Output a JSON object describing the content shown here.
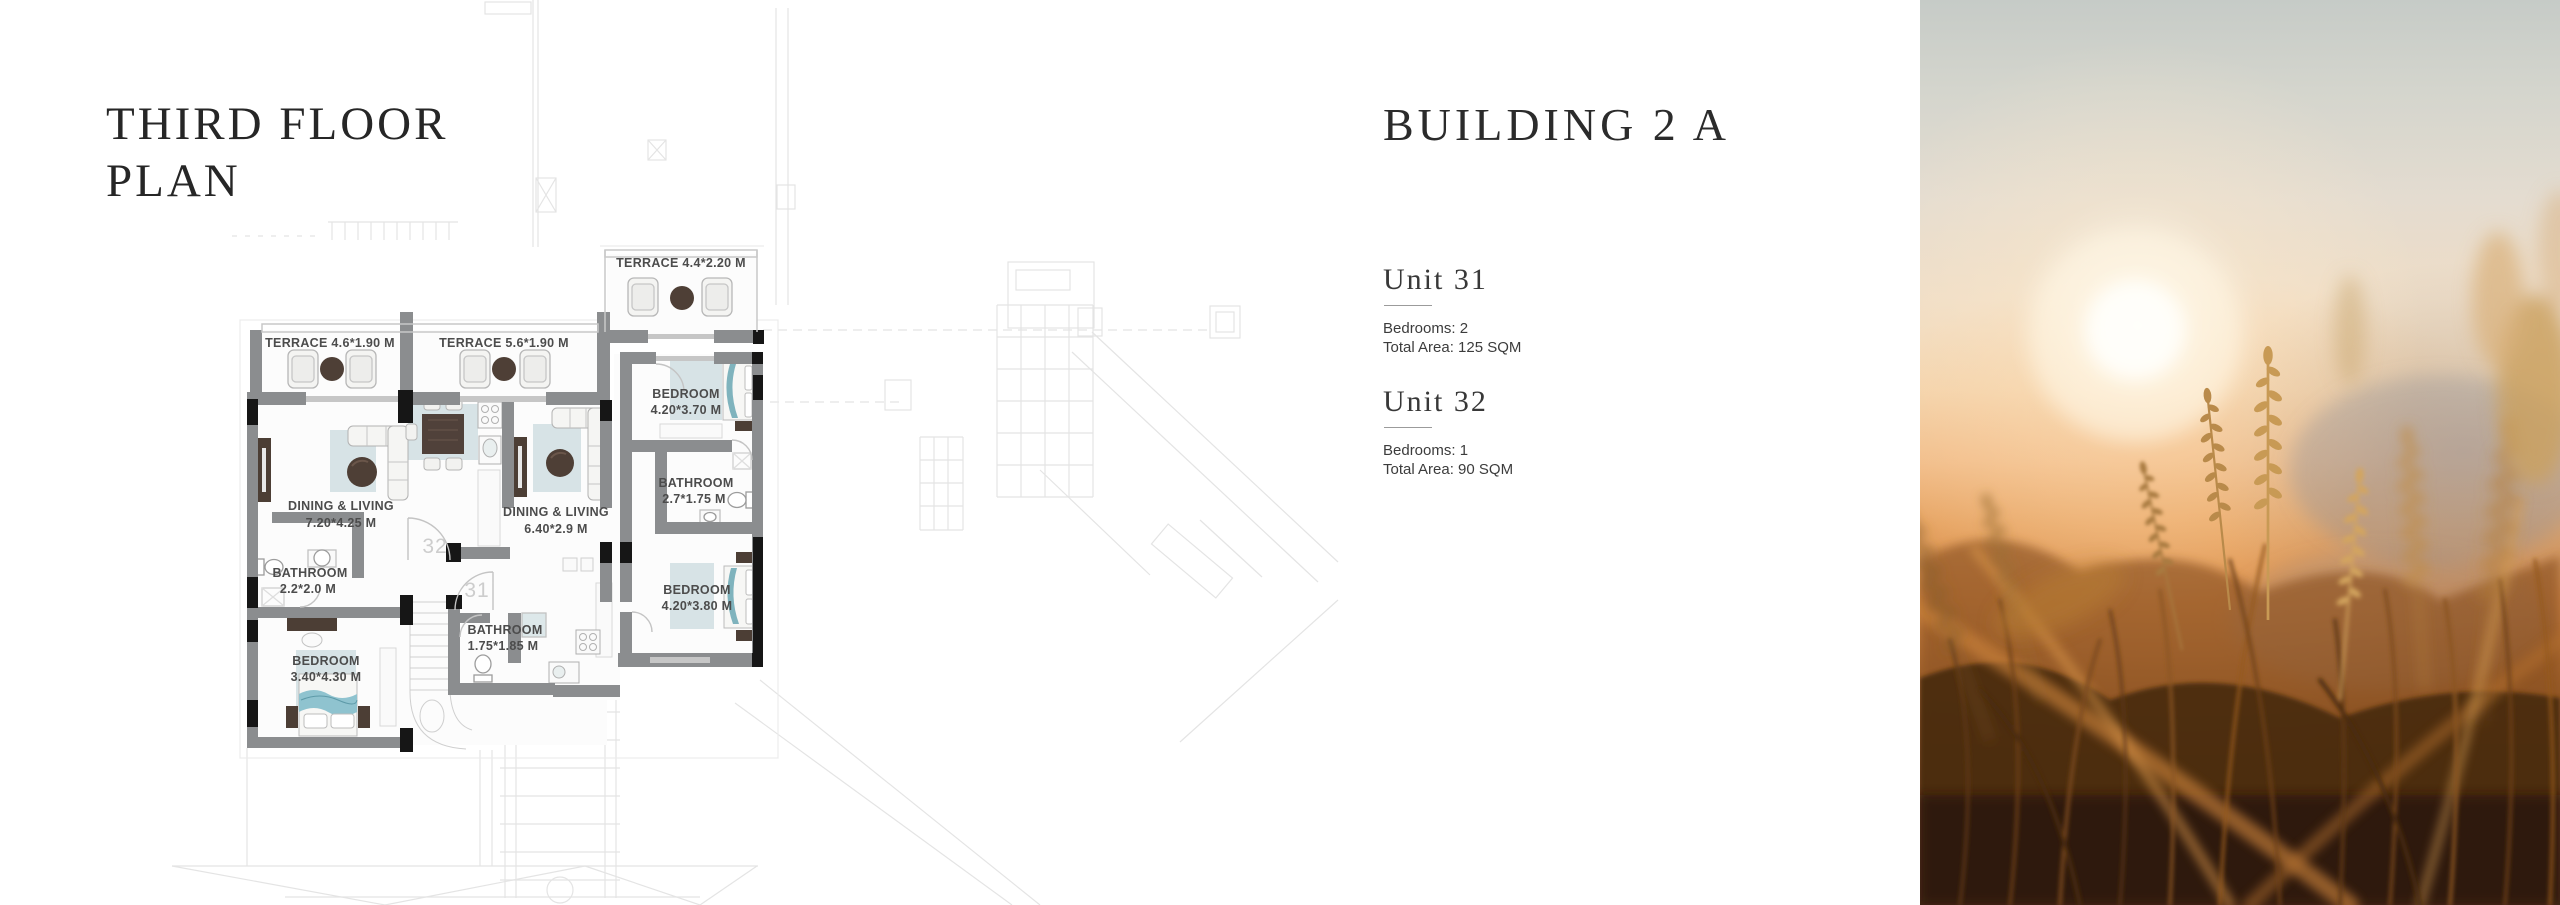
{
  "page": {
    "title_lines": [
      "THIRD FLOOR",
      "PLAN"
    ]
  },
  "building": {
    "heading": "BUILDING 2 A",
    "units": [
      {
        "name": "Unit 31",
        "bedrooms": "Bedrooms: 2",
        "total_area": "Total Area: 125 SQM"
      },
      {
        "name": "Unit 32",
        "bedrooms": "Bedrooms: 1",
        "total_area": "Total Area: 90 SQM"
      }
    ]
  },
  "floor_plan": {
    "terraces": {
      "top": "TERRACE 4.4*2.20 M",
      "left": "TERRACE 4.6*1.90 M",
      "middle": "TERRACE 5.6*1.90 M"
    },
    "rooms": {
      "living_left": {
        "name": "DINING & LIVING",
        "dims": "7.20*4.25 M"
      },
      "living_mid": {
        "name": "DINING & LIVING",
        "dims": "6.40*2.9 M"
      },
      "bathroom_left": {
        "name": "BATHROOM",
        "dims": "2.2*2.0 M"
      },
      "bedroom_left": {
        "name": "BEDROOM",
        "dims": "3.40*4.30 M"
      },
      "bathroom_mid": {
        "name": "BATHROOM",
        "dims": "1.75*1.85 M"
      },
      "bedroom_top_right": {
        "name": "BEDROOM",
        "dims": "4.20*3.70 M"
      },
      "bathroom_right": {
        "name": "BATHROOM",
        "dims": "2.7*1.75 M"
      },
      "bedroom_bottom_right": {
        "name": "BEDROOM",
        "dims": "4.20*3.80 M"
      }
    },
    "unit_numbers": {
      "left": "32",
      "right": "31"
    }
  },
  "colors": {
    "wall_gray": "#8b8d8f",
    "window_black": "#161616",
    "furniture_dark_brown": "#50413a",
    "rug_blue": "#d7e3e6",
    "bed_teal": "#7fb3bd",
    "label_gray": "#4c4c4c",
    "faint_line": "#e4e4e4",
    "photo_orange": "#cd8140",
    "photo_sky": "#c6cbc7"
  }
}
